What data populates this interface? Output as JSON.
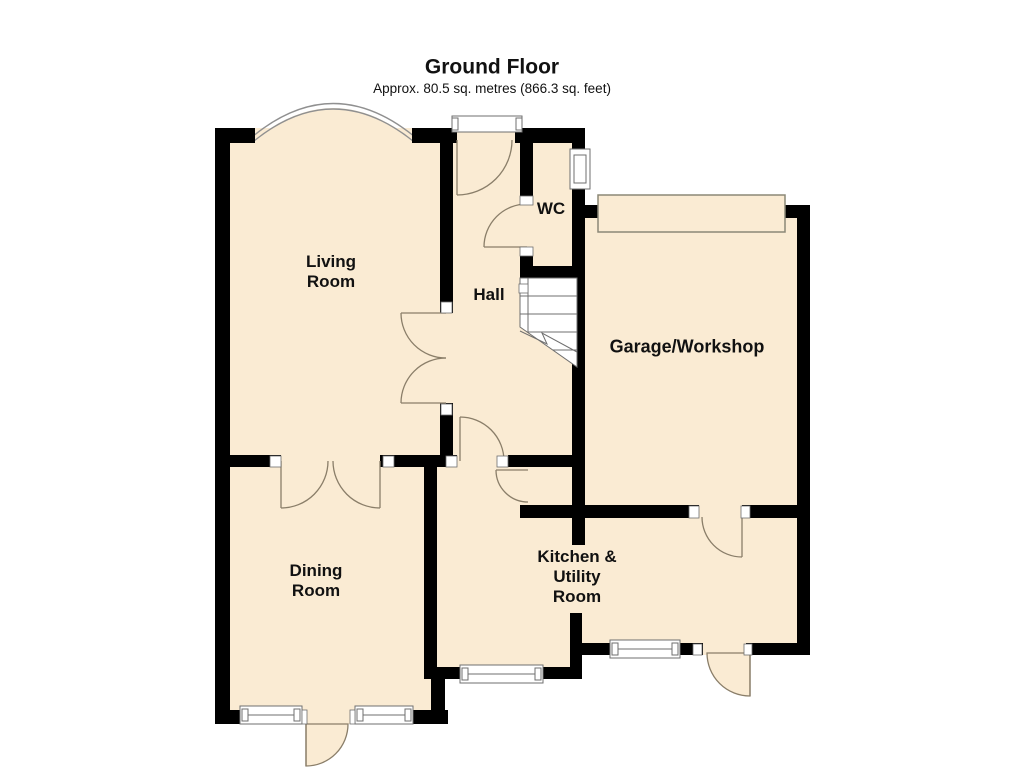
{
  "header": {
    "title": "Ground Floor",
    "subtitle": "Approx. 80.5 sq. metres (866.3 sq. feet)"
  },
  "rooms": {
    "living": {
      "label": "Living\nRoom"
    },
    "hall": {
      "label": "Hall"
    },
    "wc": {
      "label": "WC"
    },
    "garage": {
      "label": "Garage/Workshop"
    },
    "dining": {
      "label": "Dining\nRoom"
    },
    "kitchen": {
      "label": "Kitchen &\nUtility\nRoom"
    }
  },
  "colors": {
    "room_fill": "#faebd3",
    "wall": "#000000",
    "arc_line": "#8a7e69",
    "thin_line": "#6f6f6f",
    "bay_line": "#909090",
    "door_panel_line": "#8b8877",
    "background": "#ffffff",
    "text": "#111111"
  }
}
